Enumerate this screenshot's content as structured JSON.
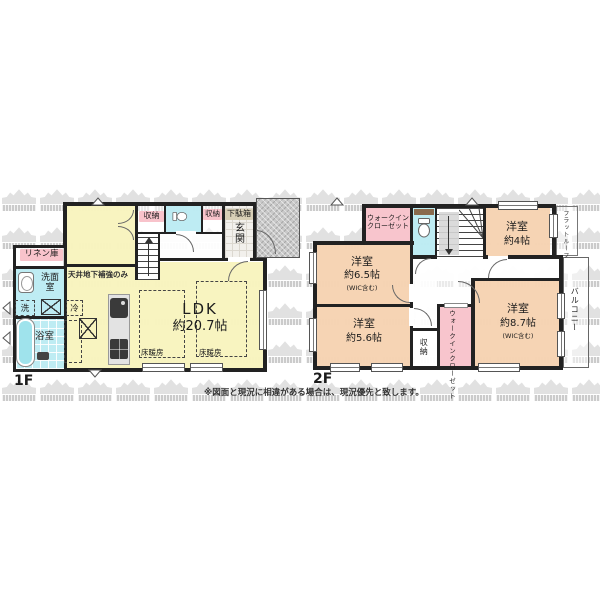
{
  "colors": {
    "wall": "#222222",
    "ldk_yellow": "#f8f3bd",
    "bedroom_peach": "#f6d2b0",
    "wet_cyan": "#baebf2",
    "closet_pink": "#f8c3cb",
    "shoe_tan": "#d8cfb6",
    "porch_gray": "#c9c9c9",
    "watermark_gray": "#d9d9d9"
  },
  "disclaimer": "※図面と現況に相違がある場合は、現況優先と致します。",
  "floor1": {
    "label": "1F",
    "ldk": {
      "name": "LDK",
      "size": "約20.7帖"
    },
    "linen_closet": "リネン庫",
    "washroom": "洗面室",
    "washer": "洗",
    "bathroom": "浴室",
    "fridge": "冷",
    "storage_a": "収納",
    "storage_b": "収納",
    "shoe_cabinet": "下駄箱",
    "entrance": "玄関",
    "floor_heating_a": "床暖房",
    "floor_heating_b": "床暖房",
    "ceiling_note": "天井地下補強のみ"
  },
  "floor2": {
    "label": "2F",
    "rooms": [
      {
        "name": "洋室",
        "size": "約6.5帖",
        "note": "(WIC含む)"
      },
      {
        "name": "洋室",
        "size": "約4帖",
        "note": ""
      },
      {
        "name": "洋室",
        "size": "約8.7帖",
        "note": "(WIC含む)"
      },
      {
        "name": "洋室",
        "size": "約5.6帖",
        "note": ""
      }
    ],
    "walkin_closet_top": {
      "line1": "ウォークイン",
      "line2": "クローゼット"
    },
    "walkin_closet_side": "ウォークインクローゼット",
    "storage": "収納",
    "balcony": "バルコニー",
    "flat_roof": "フラットルーフ"
  }
}
